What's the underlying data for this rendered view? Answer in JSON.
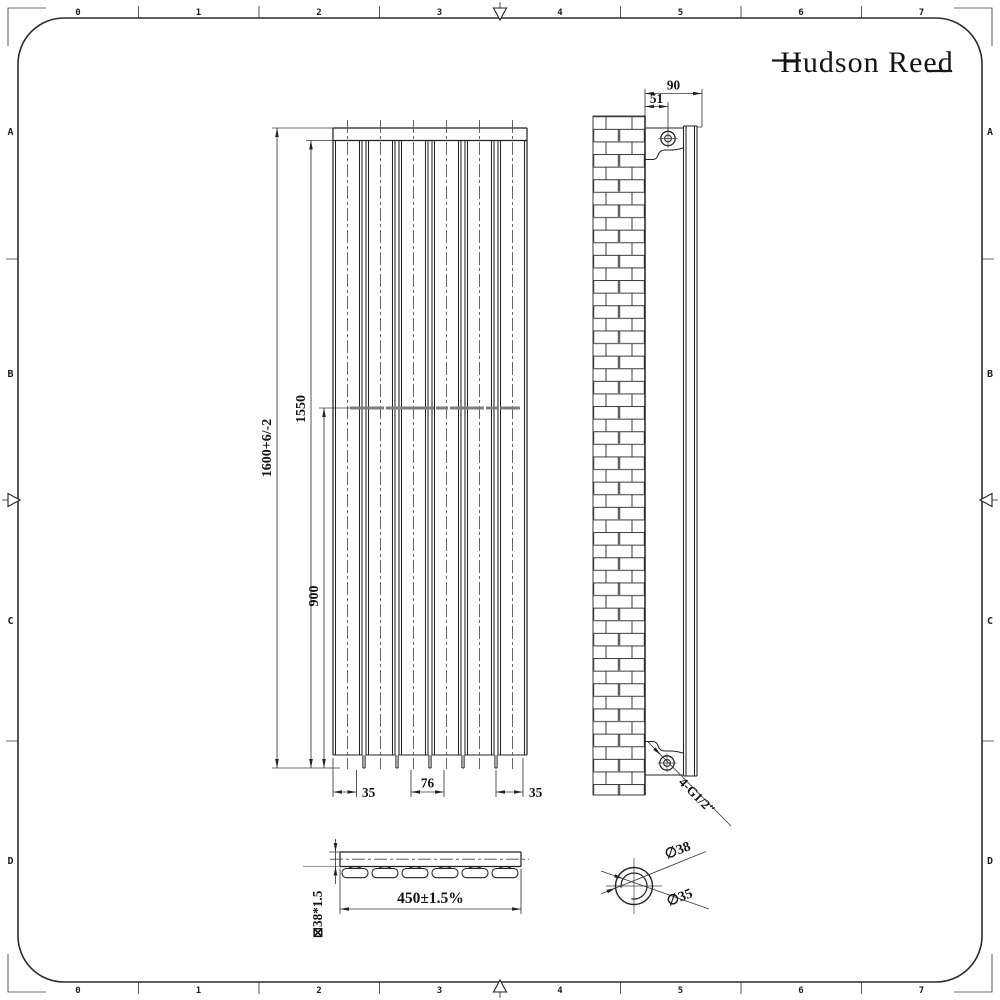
{
  "brand": {
    "name": "Hudson Reed"
  },
  "frame": {
    "columns": [
      "0",
      "1",
      "2",
      "3",
      "4",
      "5",
      "6",
      "7"
    ],
    "rows": [
      "A",
      "B",
      "C",
      "D"
    ]
  },
  "front_view": {
    "dims": {
      "overall_height": "1600+6/-2",
      "upper_height": "1550",
      "bracket_span": "900",
      "bottom_left": "35",
      "bottom_center": "76",
      "bottom_right": "35"
    }
  },
  "side_view": {
    "dims": {
      "depth": "90",
      "wall_offset": "51",
      "connections": "4-G1/2″"
    }
  },
  "section_view": {
    "dims": {
      "width": "450±1.5%",
      "tube": "⊠38*1.5"
    }
  },
  "detail_view": {
    "dims": {
      "outer": "∅38",
      "inner": "∅35"
    }
  },
  "colors": {
    "line": "#232323",
    "bracket_bar": "#7d7d7d",
    "background": "#ffffff"
  }
}
